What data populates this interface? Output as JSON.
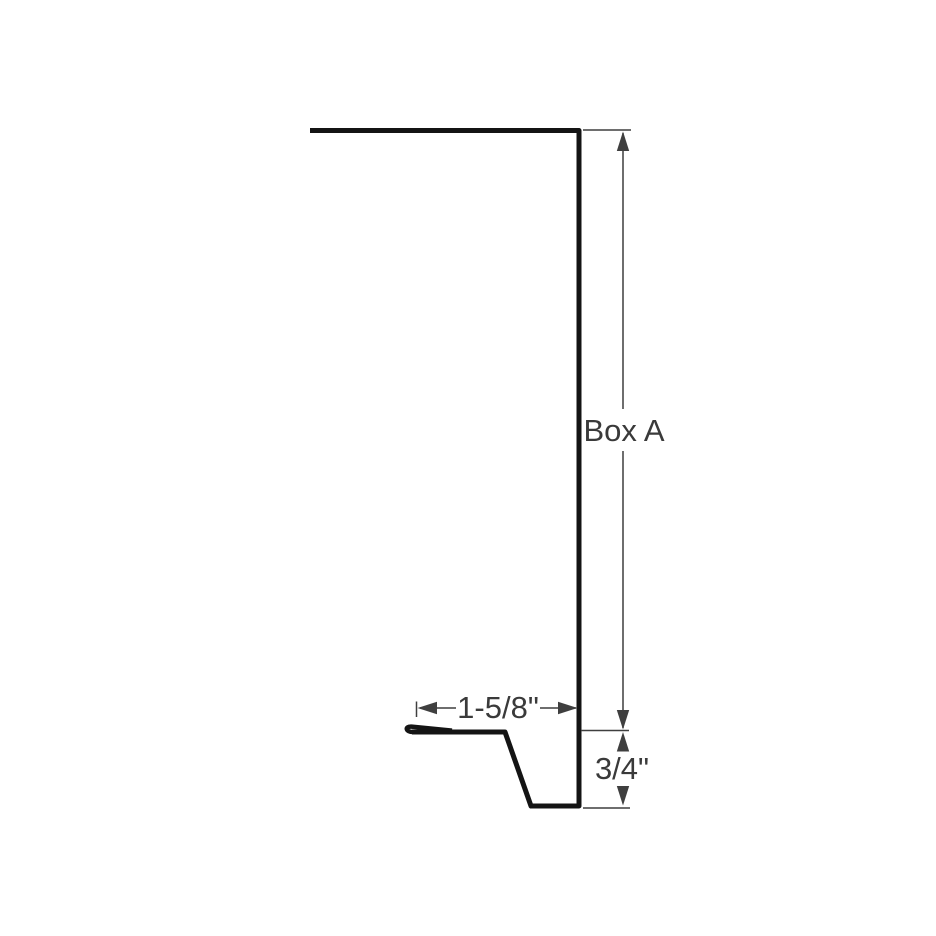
{
  "diagram": {
    "type": "technical-profile-drawing",
    "subject": "sheet-metal box trim profile cross-section",
    "labels": {
      "vertical_main_dim": "Box A",
      "horizontal_bottom_dim": "1-5/8\"",
      "vertical_kick_dim": "3/4\""
    },
    "colors": {
      "profile": "#141414",
      "dimension": "#3f3f3f",
      "text": "#3a3a3a",
      "background": "#ffffff"
    }
  }
}
